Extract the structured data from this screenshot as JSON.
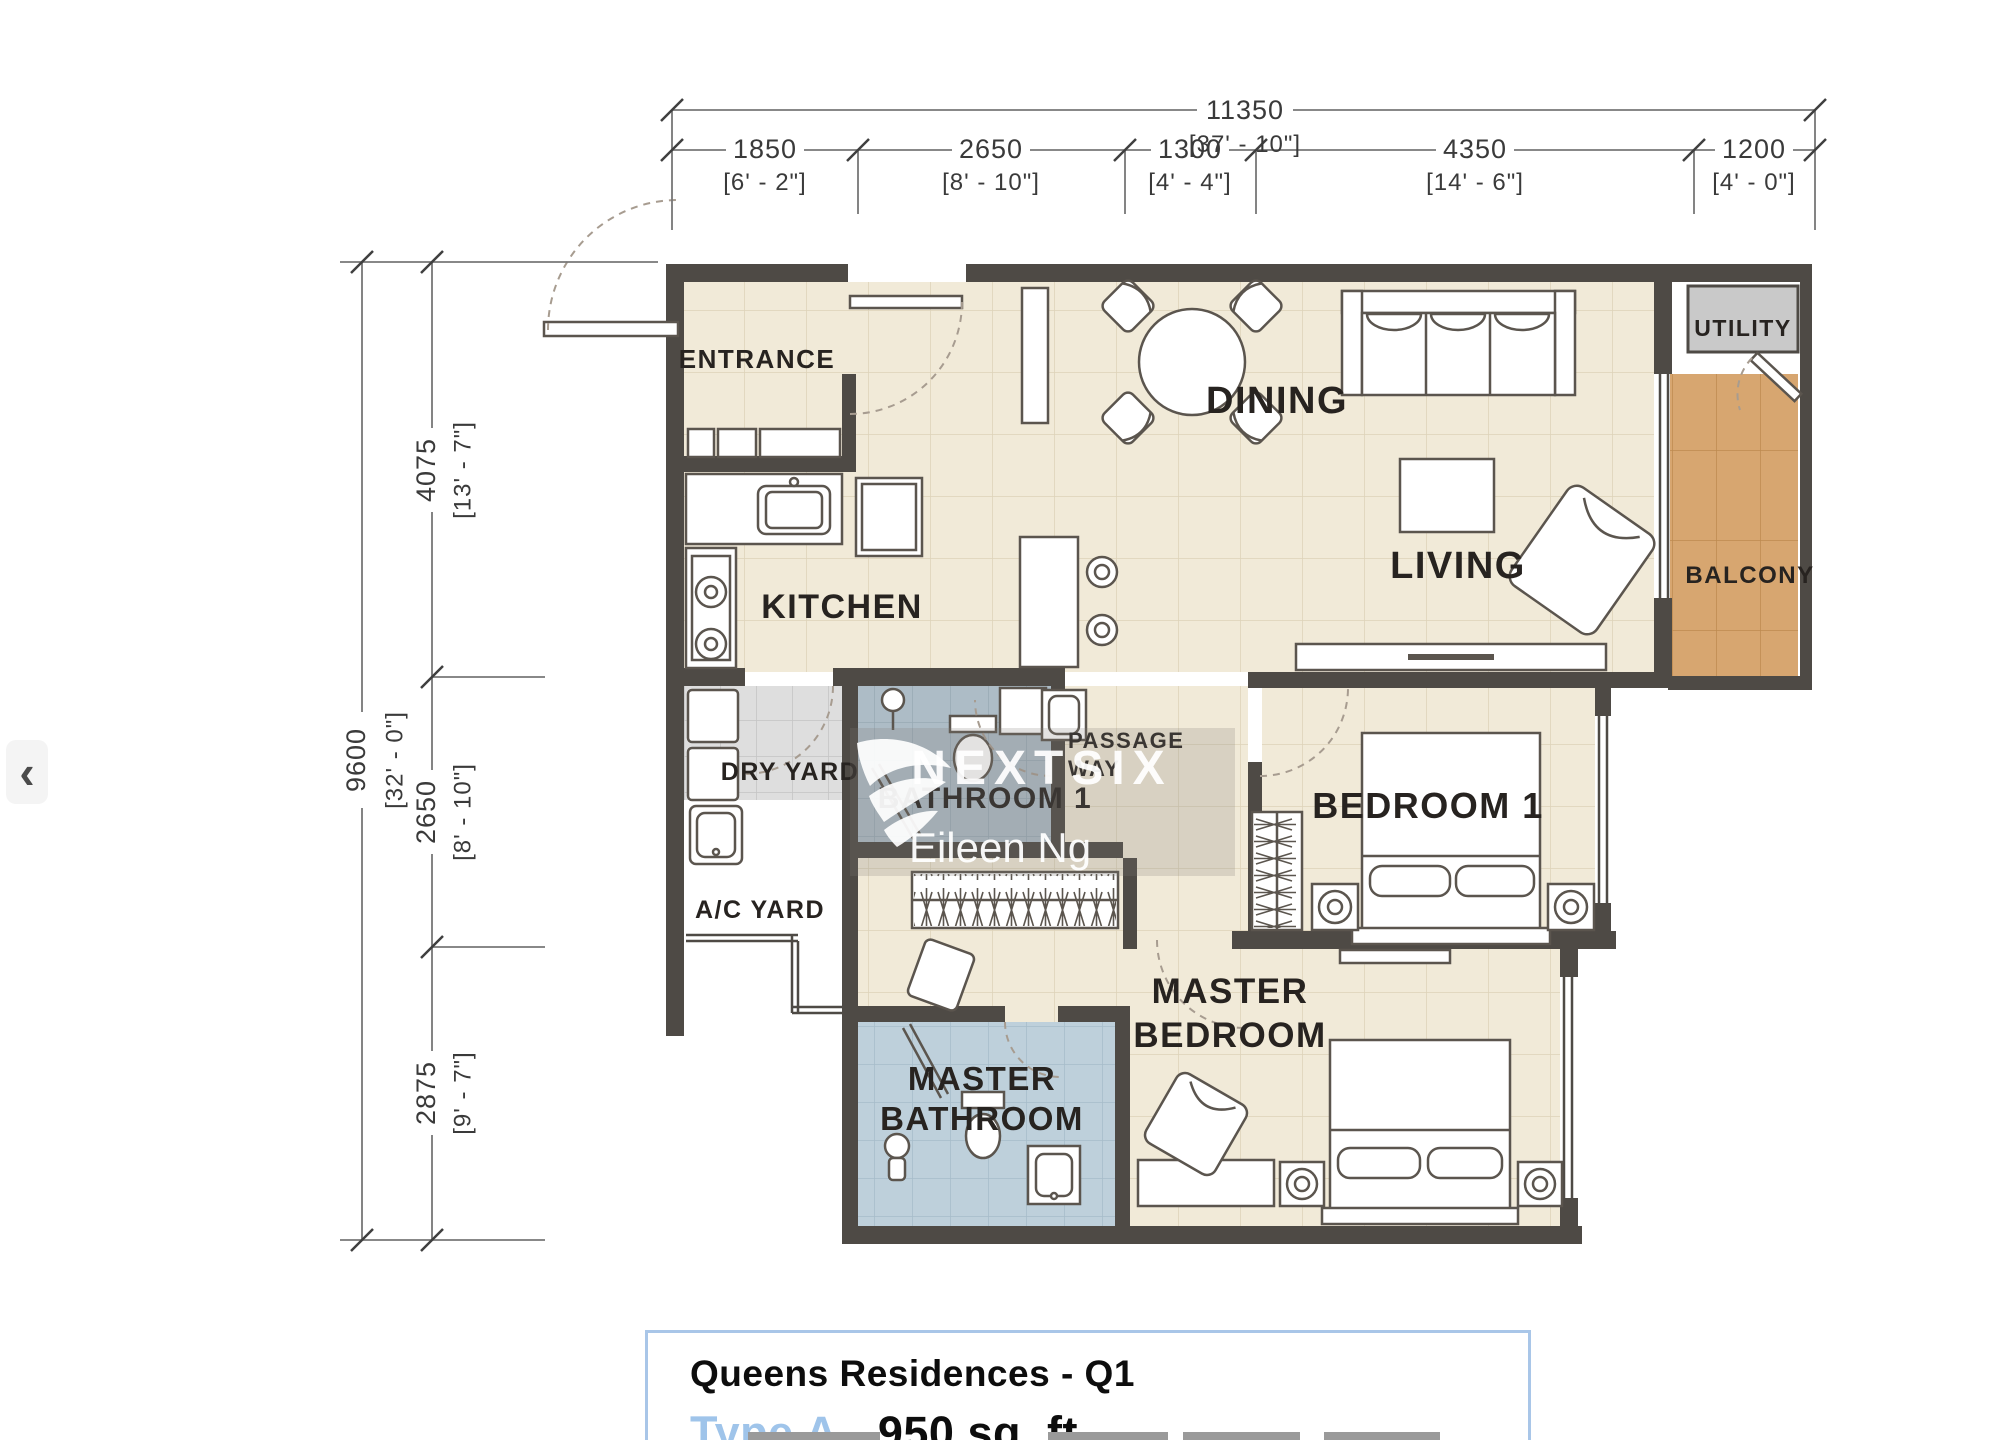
{
  "nav": {
    "prev": "‹"
  },
  "watermark": {
    "brand": "NEXTSIX",
    "agent": "Eileen Ng"
  },
  "title_block": {
    "project": "Queens Residences - Q1",
    "unit_type": "Type A",
    "area": "- 950 sq. ft."
  },
  "plan": {
    "rooms": {
      "entrance": "ENTRANCE",
      "kitchen": "KITCHEN",
      "dining": "DINING",
      "living": "LIVING",
      "utility": "UTILITY",
      "balcony": "BALCONY",
      "dry_yard": "DRY YARD",
      "ac_yard": "A/C YARD",
      "bathroom1": "BATHROOM 1",
      "passage_line1": "PASSAGE",
      "passage_line2": "WAY",
      "bedroom1": "BEDROOM 1",
      "master_bedroom_line1": "MASTER",
      "master_bedroom_line2": "BEDROOM",
      "master_bathroom_line1": "MASTER",
      "master_bathroom_line2": "BATHROOM"
    },
    "dims": {
      "top_total_mm": "11350",
      "top_total_ft": "[37' - 10\"]",
      "top_segments": [
        {
          "mm": "1850",
          "ft": "[6' - 2\"]"
        },
        {
          "mm": "2650",
          "ft": "[8' - 10\"]"
        },
        {
          "mm": "1300",
          "ft": "[4' - 4\"]"
        },
        {
          "mm": "4350",
          "ft": "[14' - 6\"]"
        },
        {
          "mm": "1200",
          "ft": "[4' - 0\"]"
        }
      ],
      "left_total_mm": "9600",
      "left_total_ft": "[32' - 0\"]",
      "left_segments": [
        {
          "mm": "4075",
          "ft": "[13' - 7\"]"
        },
        {
          "mm": "2650",
          "ft": "[8' - 10\"]"
        },
        {
          "mm": "2875",
          "ft": "[9' - 7\"]"
        }
      ]
    }
  },
  "colors": {
    "wall": "#4e4a45",
    "floor_cream": "#f1ead8",
    "bath_blue": "#adbcc6",
    "master_bath_blue": "#bed0db",
    "balcony_wood": "#d7a670",
    "utility_gray": "#c9c9c9",
    "type_label_blue": "#9fc4ea",
    "title_border_blue": "#a9c6e8"
  }
}
